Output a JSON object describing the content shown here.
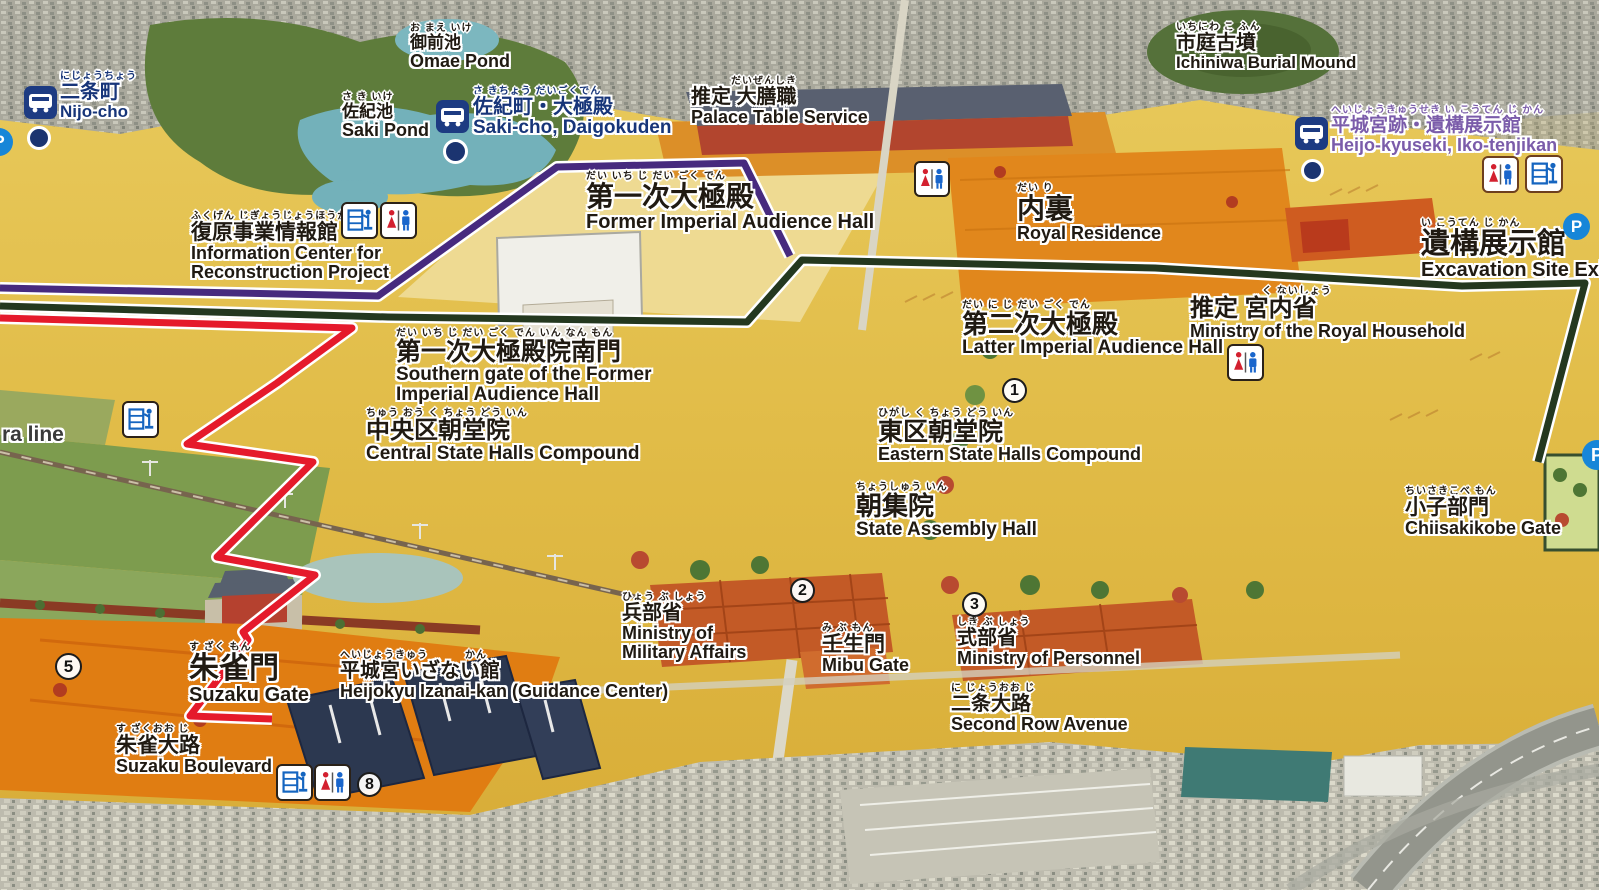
{
  "map": {
    "description_colors": {
      "route_purple": "#472a7e",
      "route_dark_green": "#24381f",
      "route_red": "#e51a2b",
      "bus_label_navy": "#173579",
      "bus_label_purple": "#7b5caa",
      "parking_blue": "#1786d8",
      "bus_icon_navy": "#1d3b82"
    },
    "labels": [
      {
        "id": "nijo-cho",
        "furigana": "にじょうちょう",
        "ja": "二条町",
        "en": "Nijo-cho"
      },
      {
        "id": "omae-pond",
        "furigana": "お まえ いけ",
        "ja": "御前池",
        "en": "Omae Pond"
      },
      {
        "id": "saki-pond",
        "furigana": "さ き いけ",
        "ja": "佐紀池",
        "en": "Saki Pond"
      },
      {
        "id": "saki-cho-daigokuden",
        "furigana": "さ きちょう だいごくでん",
        "ja": "佐紀町・大極殿",
        "en": "Saki-cho, Daigokuden"
      },
      {
        "id": "info-center",
        "furigana": "ふくげん じぎょうじょうほうかん",
        "ja": "復原事業情報館",
        "en": "Information Center for",
        "en2": "Reconstruction Project"
      },
      {
        "id": "palace-table-service",
        "furigana": "だいぜんしき",
        "ja": "推定 大膳職",
        "en": "Palace Table Service"
      },
      {
        "id": "ichiniwa-burial-mound",
        "furigana": "いちにわ こ ふん",
        "ja": "市庭古墳",
        "en": "Ichiniwa Burial Mound"
      },
      {
        "id": "heijo-kyuseki-bus",
        "furigana": "へいじょうきゅうせき い こうてん じ かん",
        "ja": "平城宮跡・遺構展示館",
        "en": "Heijo-kyuseki, Iko-tenjikan"
      },
      {
        "id": "former-audience-hall",
        "furigana": "だい いち じ だい ごく でん",
        "ja": "第一次大極殿",
        "en": "Former Imperial Audience Hall"
      },
      {
        "id": "royal-residence",
        "furigana": "だい り",
        "ja": "内裏",
        "en": "Royal Residence"
      },
      {
        "id": "excavation-site-exhibit",
        "furigana": "い こうてん じ かん",
        "ja": "遺構展示館",
        "en": "Excavation Site Exhibit"
      },
      {
        "id": "latter-audience-hall",
        "furigana": "だい に じ だい ごく でん",
        "ja": "第二次大極殿",
        "en": "Latter Imperial Audience Hall"
      },
      {
        "id": "ministry-royal-household",
        "furigana": "く ないしょう",
        "ja": "推定 宮内省",
        "en": "Ministry of the Royal Household"
      },
      {
        "id": "southern-gate",
        "furigana": "だい いち じ だい ごく でん いん なん もん",
        "ja": "第一次大極殿院南門",
        "en": "Southern gate of the Former",
        "en2": "Imperial Audience Hall"
      },
      {
        "id": "central-state-halls",
        "furigana": "ちゅう おう く ちょう どう いん",
        "ja": "中央区朝堂院",
        "en": "Central State Halls Compound"
      },
      {
        "id": "eastern-state-halls",
        "furigana": "ひがし く ちょう どう いん",
        "ja": "東区朝堂院",
        "en": "Eastern State Halls Compound"
      },
      {
        "id": "state-assembly-hall",
        "furigana": "ちょうしゅう いん",
        "ja": "朝集院",
        "en": "State Assembly Hall"
      },
      {
        "id": "chiisakikobe-gate",
        "furigana": "ちいさきこべ もん",
        "ja": "小子部門",
        "en": "Chiisakikobe Gate"
      },
      {
        "id": "ministry-military",
        "furigana": "ひょう ぶ しょう",
        "ja": "兵部省",
        "en": "Ministry of",
        "en2": "Military Affairs"
      },
      {
        "id": "mibu-gate",
        "furigana": "み ぶ もん",
        "ja": "壬生門",
        "en": "Mibu Gate"
      },
      {
        "id": "ministry-personnel",
        "furigana": "しき ぶ しょう",
        "ja": "式部省",
        "en": "Ministry of Personnel"
      },
      {
        "id": "second-row-avenue",
        "furigana": "に じょうおお じ",
        "ja": "二条大路",
        "en": "Second Row Avenue"
      },
      {
        "id": "suzaku-gate",
        "furigana": "す ざく もん",
        "ja": "朱雀門",
        "en": "Suzaku Gate"
      },
      {
        "id": "izanai-kan",
        "furigana": "へいじょうきゅう",
        "furigana2": "かん",
        "ja": "平城宮いざない館",
        "en": "Heijokyu Izanai-kan (Guidance Center)"
      },
      {
        "id": "suzaku-boulevard",
        "furigana": "す ざくおお じ",
        "ja": "朱雀大路",
        "en": "Suzaku Boulevard"
      },
      {
        "id": "rail-line",
        "en": "ra line"
      }
    ],
    "numbers": [
      "1",
      "2",
      "3",
      "5",
      "8"
    ],
    "icon_glyphs": {
      "bus-icon": "white bus pictogram on navy rounded square",
      "bus-stop-dot": "navy circle with white ring",
      "toilet-icon": "red female and blue male pictogram in white rounded square",
      "museum-icon": "blue display-case with person pictogram in white rounded square",
      "parking-icon": "white P on blue circle"
    },
    "parking_letter": "P"
  }
}
